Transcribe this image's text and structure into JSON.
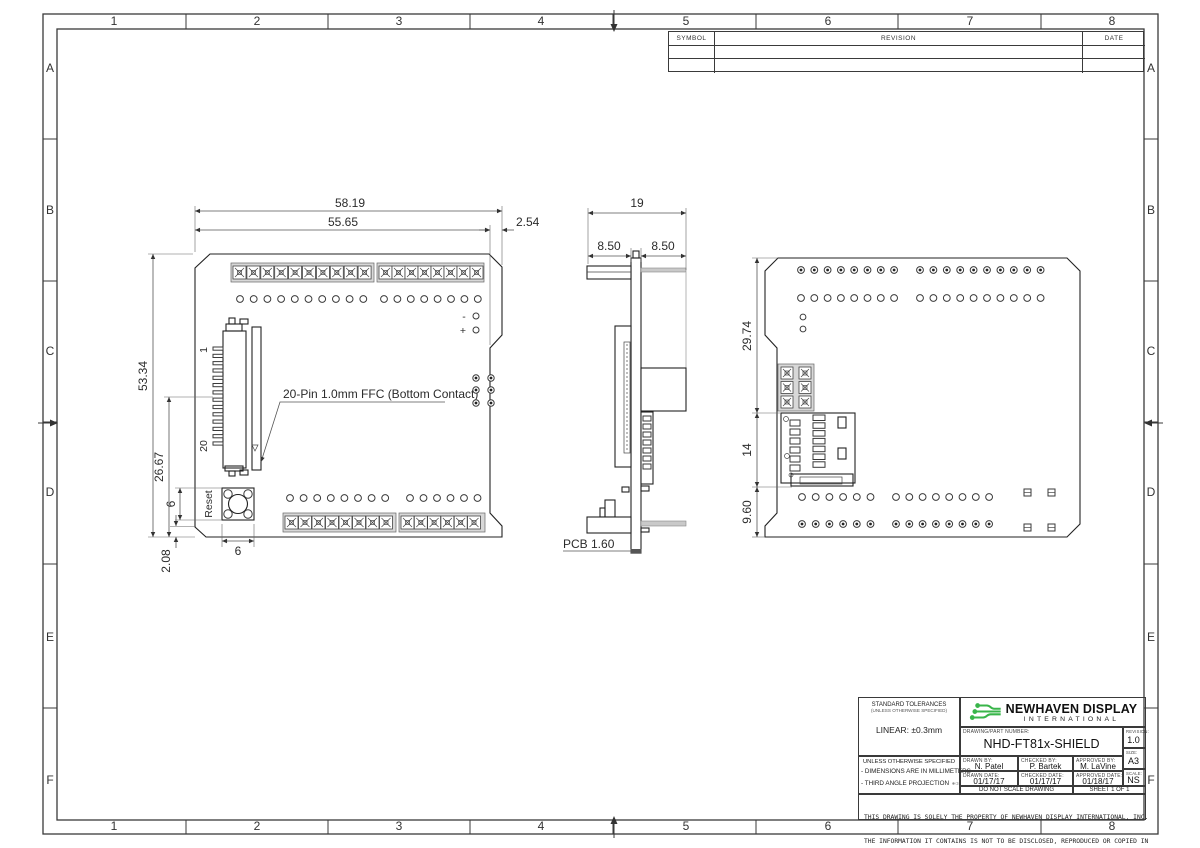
{
  "sheet": {
    "columns": [
      "1",
      "2",
      "3",
      "4",
      "5",
      "6",
      "7",
      "8"
    ],
    "rows": [
      "A",
      "B",
      "C",
      "D",
      "E",
      "F"
    ]
  },
  "revision_table": {
    "headers": [
      "SYMBOL",
      "REVISION",
      "DATE"
    ]
  },
  "views": {
    "front": {
      "dims": {
        "w1": "58.19",
        "w2": "55.65",
        "w3": "2.54",
        "h1": "53.34",
        "h2": "26.67",
        "reset_h": "6",
        "reset_w": "6",
        "edge": "2.08"
      },
      "labels": {
        "reset": "Reset",
        "pin1": "1",
        "pin20": "20",
        "callout": "20-Pin 1.0mm FFC (Bottom Contact)",
        "minus": "-",
        "plus": "+"
      }
    },
    "side": {
      "dims": {
        "w": "19",
        "left": "8.50",
        "right": "8.50",
        "pcb": "PCB 1.60"
      }
    },
    "back": {
      "dims": {
        "upper": "29.74",
        "mid": "14",
        "lower": "9.60"
      }
    }
  },
  "pcb_features": {
    "envelopes": [
      [
        231,
        263,
        143,
        19
      ],
      [
        377,
        263,
        107,
        19
      ],
      [
        283,
        513,
        113,
        19
      ],
      [
        399,
        513,
        86,
        19
      ],
      [
        778,
        364,
        36,
        47
      ]
    ],
    "pin_rows": [
      {
        "kind": "header",
        "x": 233,
        "y": 266,
        "count": 10,
        "pitch": 13.9,
        "size": 13
      },
      {
        "kind": "header",
        "x": 379,
        "y": 266,
        "count": 8,
        "pitch": 13.0,
        "size": 13
      },
      {
        "kind": "hole",
        "cx": 240,
        "cy": 299,
        "count": 10,
        "pitch": 13.7,
        "r": 3.4
      },
      {
        "kind": "hole",
        "cx": 384,
        "cy": 299,
        "count": 8,
        "pitch": 13.4,
        "r": 3.4
      },
      {
        "kind": "hole",
        "cx": 476,
        "cy": 316,
        "count": 1,
        "pitch": 0,
        "r": 3
      },
      {
        "kind": "hole",
        "cx": 476,
        "cy": 330,
        "count": 1,
        "pitch": 0,
        "r": 3
      },
      {
        "kind": "pad",
        "cx": 476,
        "cy": 378,
        "count": 2,
        "pitch": 15,
        "r": 3.2
      },
      {
        "kind": "pad",
        "cx": 476,
        "cy": 390,
        "count": 2,
        "pitch": 15,
        "r": 3.2
      },
      {
        "kind": "pad",
        "cx": 476,
        "cy": 403,
        "count": 2,
        "pitch": 15,
        "r": 3.2
      },
      {
        "kind": "hole",
        "cx": 290,
        "cy": 498,
        "count": 8,
        "pitch": 13.6,
        "r": 3.4
      },
      {
        "kind": "hole",
        "cx": 410,
        "cy": 498,
        "count": 6,
        "pitch": 13.5,
        "r": 3.4
      },
      {
        "kind": "header",
        "x": 285,
        "y": 516,
        "count": 8,
        "pitch": 13.5,
        "size": 13
      },
      {
        "kind": "header",
        "x": 401,
        "y": 516,
        "count": 6,
        "pitch": 13.3,
        "size": 13
      },
      {
        "kind": "vstack",
        "x": 213,
        "y": 347,
        "count": 14,
        "pitch": 7.3,
        "w": 10,
        "h": 3.2
      },
      {
        "kind": "vstack",
        "x": 643,
        "y": 416,
        "count": 7,
        "pitch": 8,
        "w": 8,
        "h": 5
      },
      {
        "kind": "pad",
        "cx": 801,
        "cy": 270,
        "count": 8,
        "pitch": 13.3,
        "r": 3.4
      },
      {
        "kind": "pad",
        "cx": 920,
        "cy": 270,
        "count": 10,
        "pitch": 13.4,
        "r": 3.4
      },
      {
        "kind": "hole",
        "cx": 801,
        "cy": 298,
        "count": 8,
        "pitch": 13.3,
        "r": 3.4
      },
      {
        "kind": "hole",
        "cx": 920,
        "cy": 298,
        "count": 10,
        "pitch": 13.4,
        "r": 3.4
      },
      {
        "kind": "hole",
        "cx": 803,
        "cy": 317,
        "count": 1,
        "pitch": 0,
        "r": 2.9
      },
      {
        "kind": "hole",
        "cx": 803,
        "cy": 329,
        "count": 1,
        "pitch": 0,
        "r": 2.9
      },
      {
        "kind": "header",
        "x": 781,
        "y": 367,
        "count": 2,
        "pitch": 18,
        "size": 12
      },
      {
        "kind": "header",
        "x": 781,
        "y": 381.5,
        "count": 2,
        "pitch": 18,
        "size": 12
      },
      {
        "kind": "header",
        "x": 781,
        "y": 396,
        "count": 2,
        "pitch": 18,
        "size": 12
      },
      {
        "kind": "vstack",
        "x": 790,
        "y": 420,
        "count": 4,
        "pitch": 9,
        "w": 10,
        "h": 6
      },
      {
        "kind": "vstack",
        "x": 790,
        "y": 456,
        "count": 2,
        "pitch": 9,
        "w": 10,
        "h": 6
      },
      {
        "kind": "vstack",
        "x": 813,
        "y": 415,
        "count": 7,
        "pitch": 7.8,
        "w": 12,
        "h": 5.5
      },
      {
        "kind": "hole",
        "cx": 802,
        "cy": 497,
        "count": 6,
        "pitch": 13.7,
        "r": 3.4
      },
      {
        "kind": "hole",
        "cx": 896,
        "cy": 497,
        "count": 8,
        "pitch": 13.3,
        "r": 3.4
      },
      {
        "kind": "pad",
        "cx": 802,
        "cy": 524,
        "count": 6,
        "pitch": 13.7,
        "r": 3.4
      },
      {
        "kind": "pad",
        "cx": 896,
        "cy": 524,
        "count": 8,
        "pitch": 13.3,
        "r": 3.4
      },
      {
        "kind": "smt",
        "x": 1024,
        "y": 489,
        "count": 2,
        "pitch": 24,
        "size": 7
      },
      {
        "kind": "smt",
        "x": 1024,
        "y": 524,
        "count": 2,
        "pitch": 24,
        "size": 7
      }
    ]
  },
  "title_block": {
    "tolerances_title": "STANDARD TOLERANCES",
    "tolerances_subtitle": "(UNLESS OTHERWISE SPECIFIED)",
    "linear": "LINEAR:  ±0.3mm",
    "notes_title": "UNLESS OTHERWISE SPECIFIED",
    "note_mm": "- DIMENSIONS ARE IN MILLIMETERS",
    "note_proj": "- THIRD ANGLE PROJECTION",
    "part_label": "DRAWING/PART NUMBER:",
    "part_number": "NHD-FT81x-SHIELD",
    "drawn_by_label": "DRAWN BY:",
    "drawn_by": "N. Patel",
    "checked_by_label": "CHECKED BY:",
    "checked_by": "P. Bartek",
    "approved_by_label": "APPROVED BY:",
    "approved_by": "M. LaVine",
    "drawn_date_label": "DRAWN DATE:",
    "drawn_date": "01/17/17",
    "checked_date_label": "CHECKED DATE:",
    "checked_date": "01/17/17",
    "approved_date_label": "APPROVED DATE:",
    "approved_date": "01/18/17",
    "revision_label": "REVISION:",
    "revision": "1.0",
    "size_label": "SIZE:",
    "size": "A3",
    "scale_label": "SCALE:",
    "scale": "NS",
    "no_scale": "DO NOT SCALE DRAWING",
    "sheet_of": "SHEET 1 OF 1",
    "disclaimer_line1": "THIS DRAWING IS SOLELY THE PROPERTY OF NEWHAVEN DISPLAY INTERNATIONAL, INC.",
    "disclaimer_line2": "THE INFORMATION IT CONTAINS IS NOT TO BE DISCLOSED, REPRODUCED OR COPIED IN",
    "disclaimer_line3": "WHOLE OR PART WITHOUT WRITTEN APPROVAL FROM NEWHAVEN DISPLAY."
  },
  "logo": {
    "name": "NEWHAVEN DISPLAY",
    "sub": "INTERNATIONAL",
    "green": "#39b54a"
  }
}
